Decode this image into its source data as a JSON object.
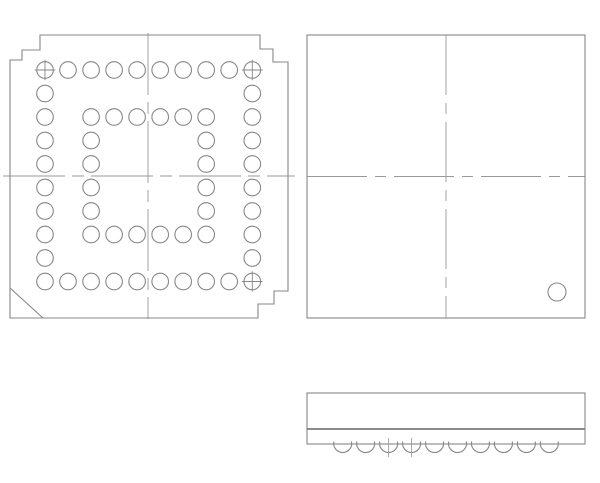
{
  "drawing": {
    "type": "ic-package-outline-drawing",
    "package_style": "56-ball BGA",
    "background_color": "#ffffff",
    "outline_color": "#878787",
    "centerline_color": "#9a9a9a",
    "views": {
      "bottom_view": {
        "label": "bottom-view-ball-grid",
        "outline_points": [
          [
            40,
            35
          ],
          [
            260,
            35
          ],
          [
            260,
            49
          ],
          [
            273,
            49
          ],
          [
            273,
            62
          ],
          [
            288,
            62
          ],
          [
            288,
            291
          ],
          [
            274,
            291
          ],
          [
            274,
            304
          ],
          [
            258,
            304
          ],
          [
            258,
            318
          ],
          [
            10,
            318
          ],
          [
            10,
            60
          ],
          [
            22,
            60
          ],
          [
            22,
            50
          ],
          [
            40,
            50
          ]
        ],
        "chamfer_line": [
          [
            10,
            288
          ],
          [
            43,
            318
          ]
        ],
        "ball_grid": {
          "cols": 10,
          "rows": 10,
          "x0": 45,
          "y0": 70,
          "pitch_x": 23.03,
          "pitch_y": 23.5,
          "ball_radius": 8.3
        },
        "ball_map": [
          "1111111111",
          "1000000001",
          "1011111101",
          "1010000101",
          "1010000101",
          "1010000101",
          "1010000101",
          "1011111101",
          "1000000001",
          "1111111111"
        ],
        "crosshair_balls": [
          [
            0,
            0
          ],
          [
            0,
            9
          ],
          [
            9,
            9
          ]
        ],
        "crosshair_half_len": 10.3,
        "centerlines": {
          "horizontal": {
            "y": 176,
            "x1": 3,
            "x2": 295
          },
          "vertical": {
            "x": 148,
            "y1": 33,
            "y2": 319
          },
          "dash": "62 7 12 7"
        }
      },
      "top_view": {
        "label": "top-view",
        "box": {
          "x": 307,
          "y": 35,
          "w": 278,
          "h": 283
        },
        "pin1_indicator": {
          "cx": 557,
          "cy": 292,
          "r": 9
        },
        "centerlines": {
          "horizontal": {
            "y": 176.5,
            "x1": 307,
            "x2": 585
          },
          "vertical": {
            "x": 446,
            "y1": 35,
            "y2": 318
          },
          "dash": "60 8 11 8"
        }
      },
      "side_view": {
        "label": "side-view",
        "box": {
          "x": 307,
          "y": 393,
          "w": 278,
          "h": 51
        },
        "standoff_line_y": 429,
        "balls": {
          "count": 10,
          "x0": 342.7,
          "pitch": 22.96,
          "radius": 9,
          "chord_y": 441.5,
          "half_chord": 8.77
        },
        "ball_centerline_indices": [
          2,
          3
        ],
        "ball_centerline_extent": [
          438,
          457
        ]
      }
    }
  }
}
